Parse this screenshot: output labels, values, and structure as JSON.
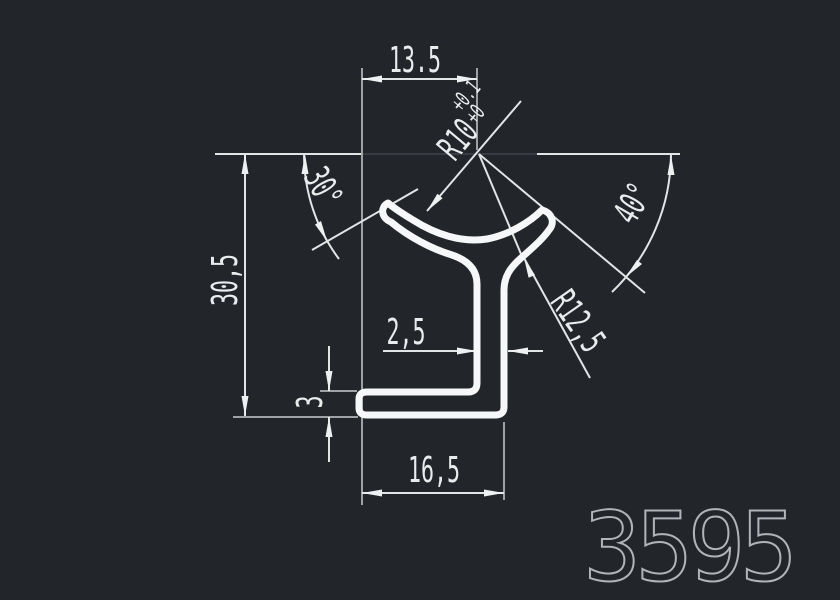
{
  "title": "Profile cross-section drawing",
  "part_number": "3595",
  "labels": {
    "dim_top_width": "13.5",
    "dim_height": "30,5",
    "dim_wall": "2,5",
    "dim_foot_height": "3",
    "dim_bottom_width": "16,5",
    "radius_inner": "R10",
    "radius_inner_tol_upper": "+0.1",
    "radius_inner_tol_lower": "+0",
    "radius_outer": "R12,5",
    "angle_left": "30°",
    "angle_right": "40°"
  },
  "colors": {
    "background": "#22262b",
    "linework": "#e2e4e6",
    "profile_outline": "#f6f7f8",
    "construction_faint": "#3f444a",
    "part_number_color": "#b0b4b8"
  }
}
